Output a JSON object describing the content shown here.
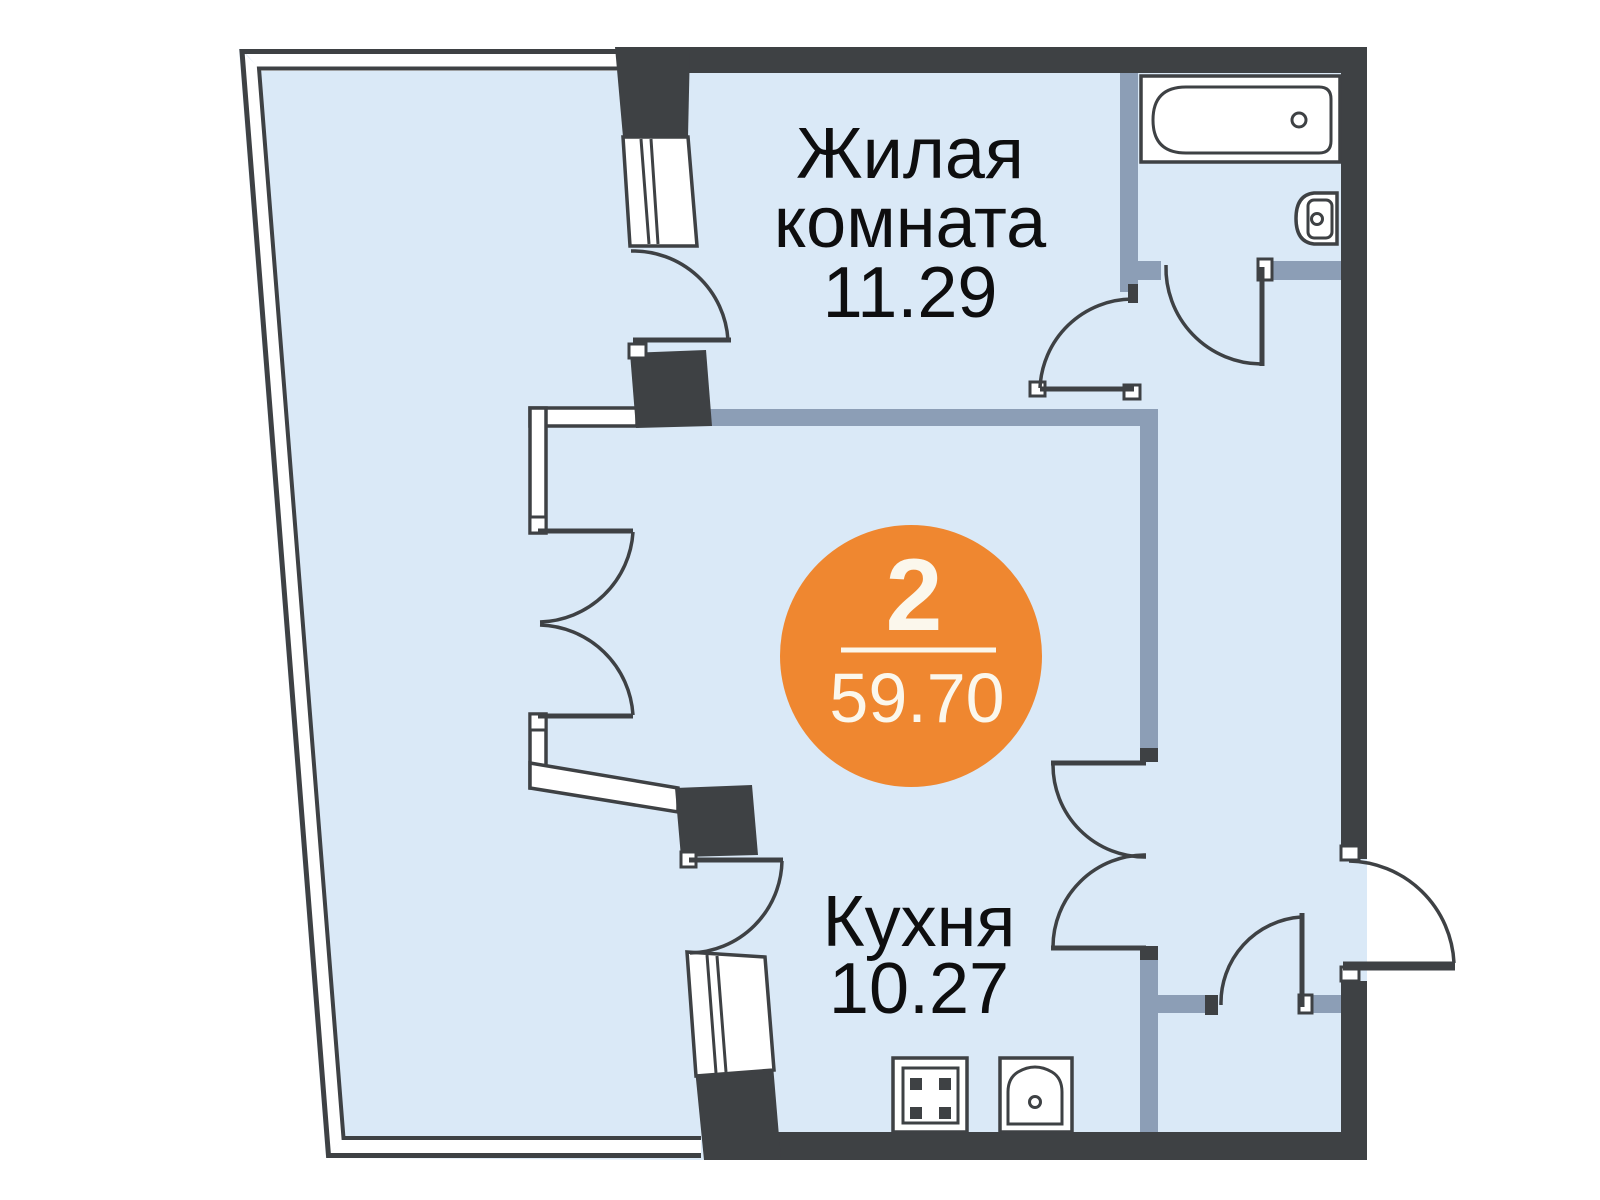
{
  "rooms": {
    "living": {
      "name_line1": "Жилая",
      "name_line2": "комната",
      "area": "11.29"
    },
    "kitchen": {
      "name": "Кухня",
      "area": "10.27"
    }
  },
  "badge": {
    "rooms_count": "2",
    "total_area": "59.70"
  },
  "colors": {
    "wall": "#3E4144",
    "partition": "#8C9EB6",
    "floor": "#DAE9F7",
    "accent_orange": "#EF8730",
    "badge_text": "#FBF7EC",
    "label_text": "#0E0E0F",
    "fixture_white": "#FFFFFF"
  },
  "icons": {
    "bathtub": "bathtub-icon",
    "washbasin": "washbasin-icon",
    "stove": "stove-icon",
    "kitchen_sink": "kitchen-sink-icon"
  }
}
